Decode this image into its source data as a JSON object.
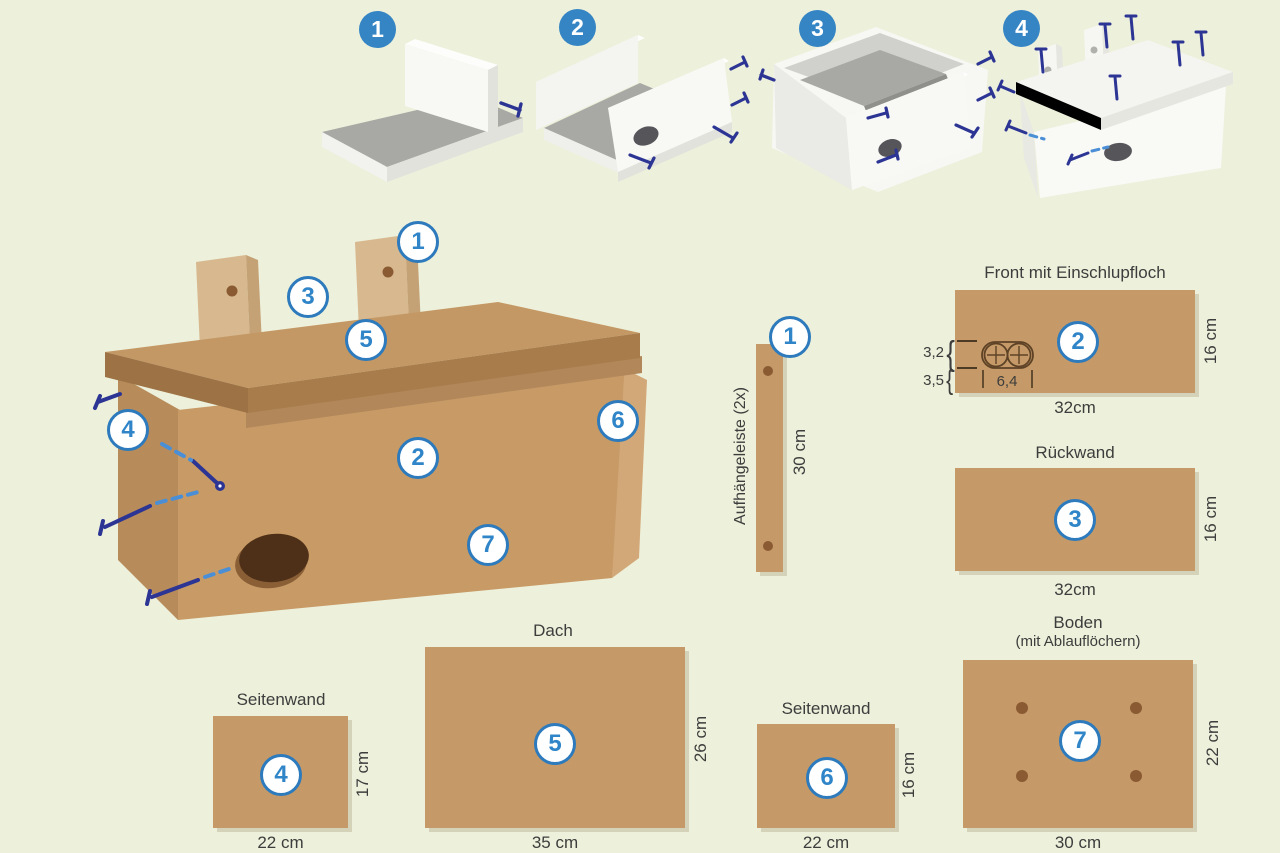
{
  "colors": {
    "background": "#edf0da",
    "wood": "#c59a68",
    "wood_front": "#c79a66",
    "wood_side": "#b88c5a",
    "wood_roof_band": "#a87c4b",
    "wood_light_strip": "#d7b88f",
    "entrance_hole": "#4e3018",
    "drain_hole": "#8a5a33",
    "badge_ring_blue": "#2d7abc",
    "badge_number_blue": "#2f85c7",
    "step_badge_blue": "#3585c5",
    "screw_navy": "#2c3594",
    "screw_dash_blue": "#4a8fd6",
    "text": "#3d3d3d",
    "white_part": "#f8f8f5",
    "inner_gray": "#a8a8a5"
  },
  "steps": {
    "s1": {
      "number": "1"
    },
    "s2": {
      "number": "2"
    },
    "s3": {
      "number": "3"
    },
    "s4": {
      "number": "4"
    }
  },
  "assembly": {
    "b1": "1",
    "b2": "2",
    "b3": "3",
    "b4": "4",
    "b5": "5",
    "b6": "6",
    "b7": "7"
  },
  "parts": {
    "hanging_strip": {
      "badge": "1",
      "label": "Aufhängeleiste (2x)",
      "length": "30 cm"
    },
    "front": {
      "badge": "2",
      "title": "Front mit Einschlupfloch",
      "width": "32cm",
      "height": "16 cm",
      "hole_top": "3,2",
      "hole_bottom": "3,5",
      "hole_width": "6,4",
      "brace": "{"
    },
    "back": {
      "badge": "3",
      "title": "Rückwand",
      "width": "32cm",
      "height": "16 cm"
    },
    "side_a": {
      "badge": "4",
      "title": "Seitenwand",
      "width": "22 cm",
      "height": "17 cm"
    },
    "roof": {
      "badge": "5",
      "title": "Dach",
      "width": "35 cm",
      "height": "26 cm"
    },
    "side_b": {
      "badge": "6",
      "title": "Seitenwand",
      "width": "22 cm",
      "height": "16 cm"
    },
    "bottom": {
      "badge": "7",
      "title": "Boden",
      "subtitle": "(mit Ablauflöchern)",
      "width": "30 cm",
      "height": "22 cm"
    }
  }
}
